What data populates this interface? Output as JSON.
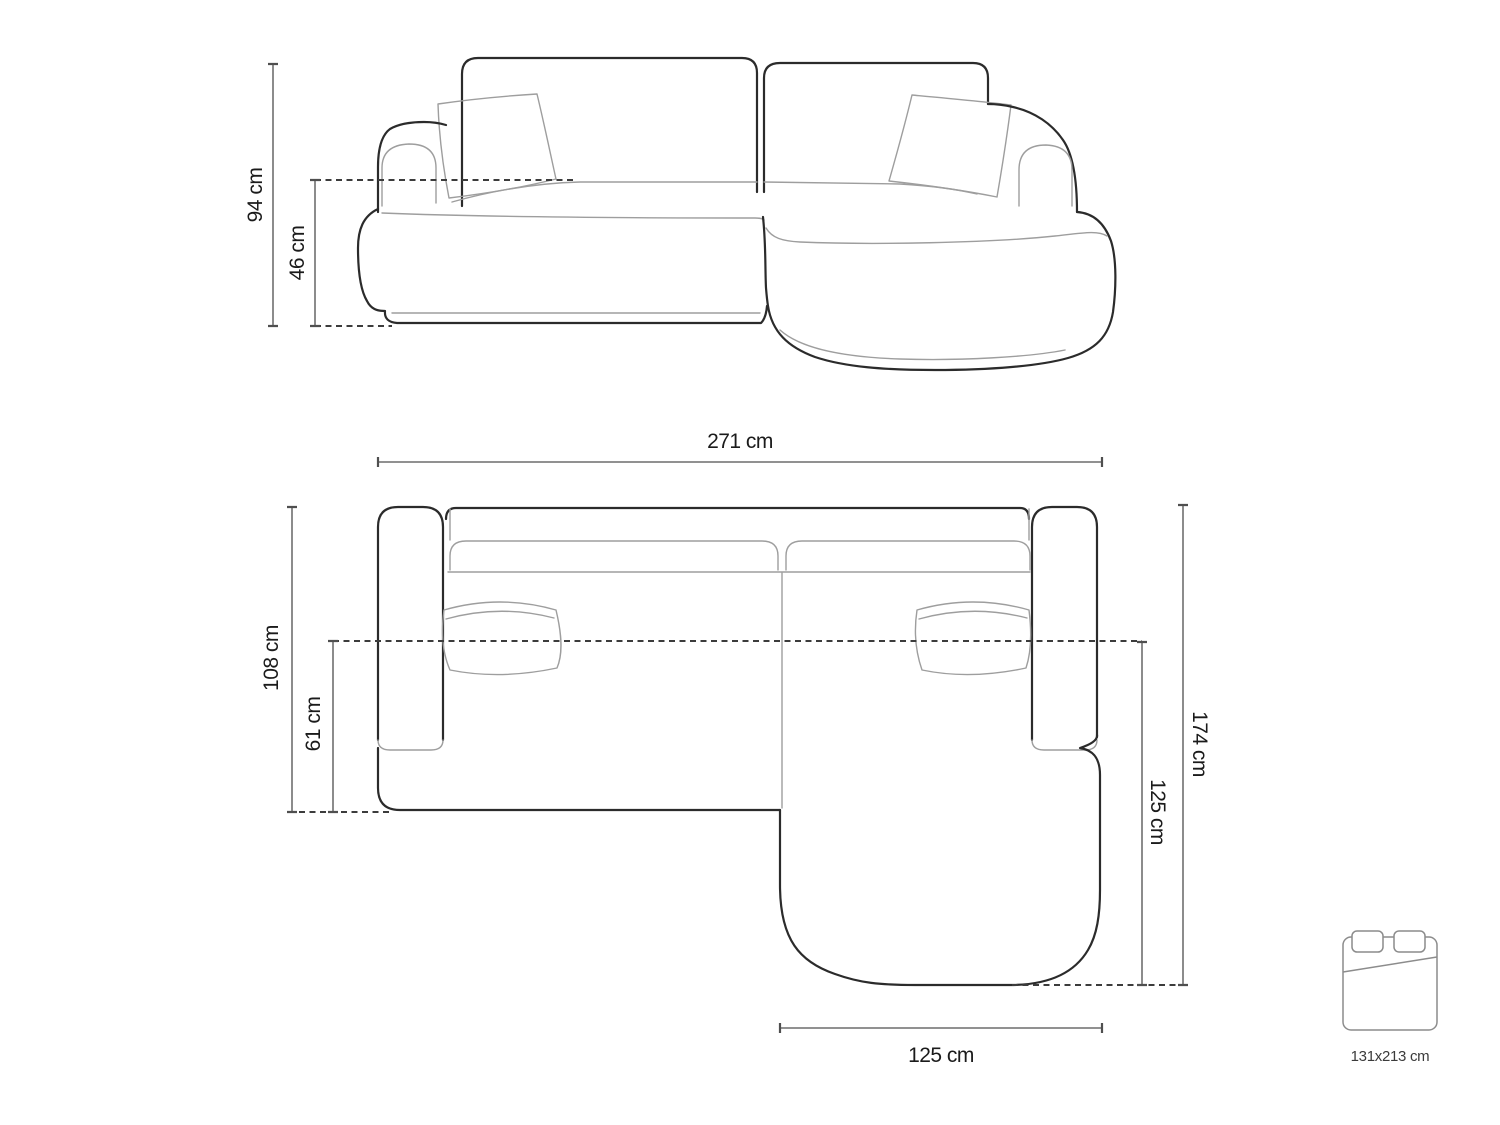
{
  "diagram": {
    "title": "corner-sofa-dimension-drawing",
    "views": [
      "front-elevation",
      "top-plan"
    ],
    "colors": {
      "background": "#ffffff",
      "outline_dark": "#2b2b2b",
      "outline_light": "#9e9e9e",
      "dimension_line": "#4f4f4f",
      "dashed_line": "#3c3c3c",
      "label_text": "#1b1b1b",
      "bed_icon": "#8c8c8c"
    }
  },
  "front_view": {
    "total_height": "94 cm",
    "seat_height": "46 cm"
  },
  "top_view": {
    "total_width": "271 cm",
    "body_depth": "108 cm",
    "seat_depth": "61 cm",
    "total_depth": "174 cm",
    "chaise_length_vertical": "125 cm",
    "chaise_width_bottom": "125 cm"
  },
  "sleeping_area": {
    "size": "131x213 cm"
  }
}
